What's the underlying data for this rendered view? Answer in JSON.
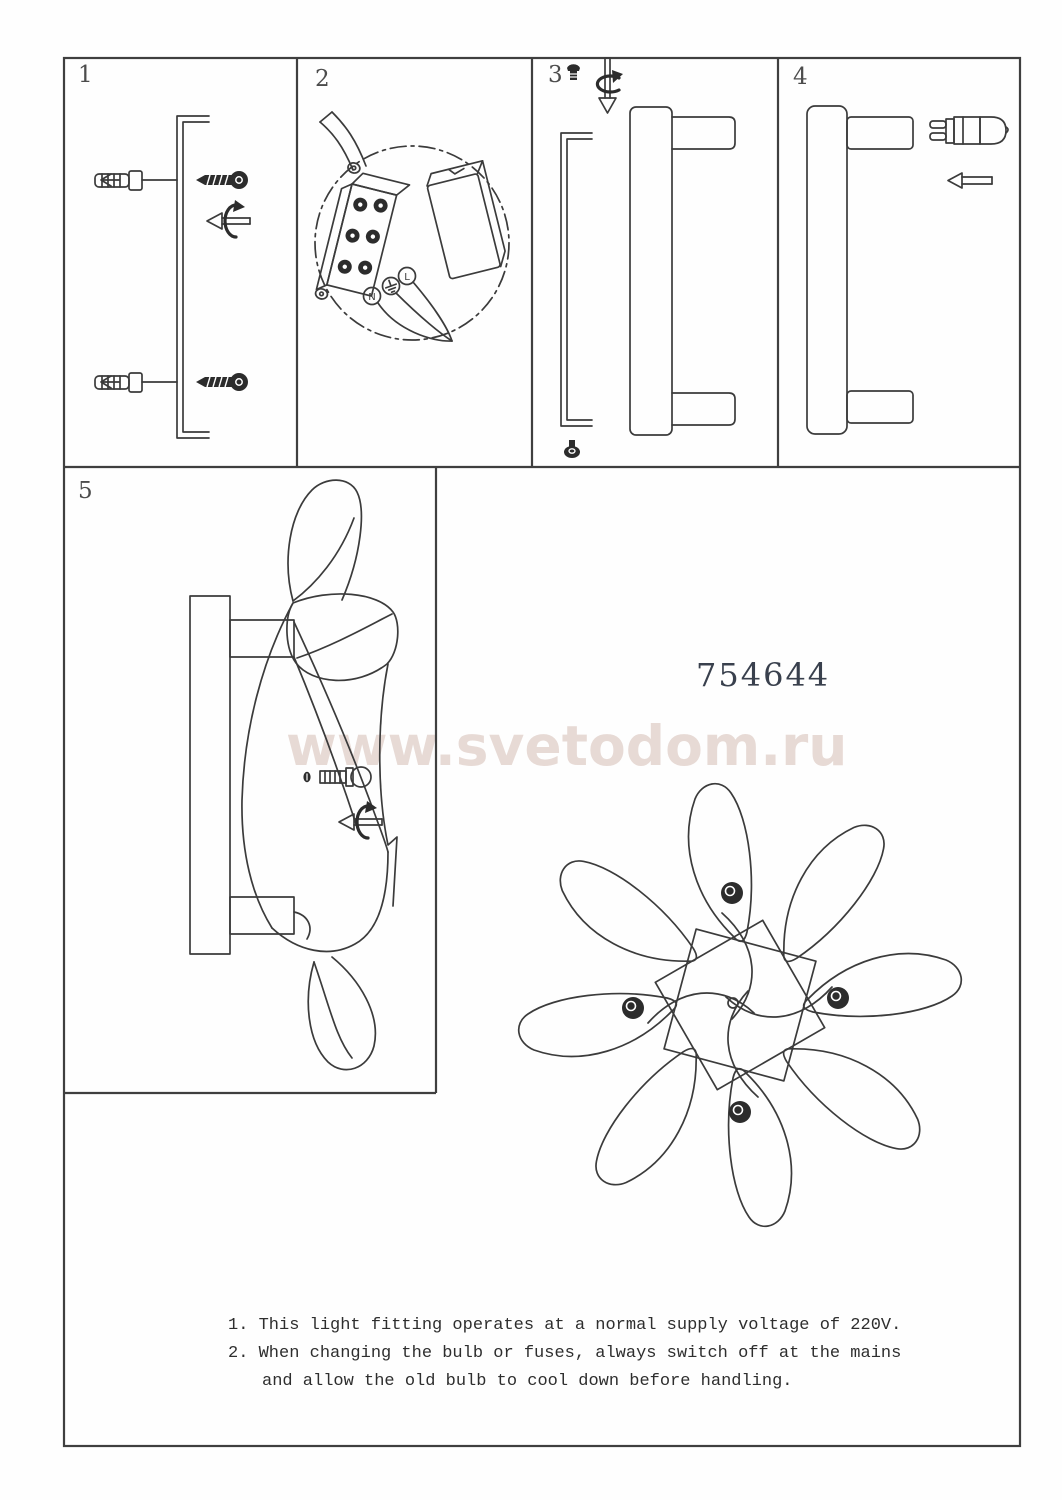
{
  "document": {
    "product_number": "754644",
    "watermark": "www.svetodom.ru",
    "notes": {
      "line1": "1. This light fitting operates at a normal supply voltage of 220V.",
      "line2": "2. When changing the bulb or fuses, always switch off at the mains",
      "line3": "and allow the old bulb to cool down before handling."
    }
  },
  "panels": {
    "p1": {
      "number": "1"
    },
    "p2": {
      "number": "2"
    },
    "p3": {
      "number": "3"
    },
    "p4": {
      "number": "4"
    },
    "p5": {
      "number": "5"
    }
  },
  "wiring": {
    "neutral": "N",
    "live": "L",
    "earth_icon": "earth-ground-symbol"
  },
  "icons": [
    "wall-anchor-icon",
    "screw-icon",
    "unscrew-rotation-arrow-icon",
    "screw-down-rotation-icon",
    "insert-arrow-icon",
    "g9-bulb-icon",
    "earth-symbol-icon"
  ],
  "colors": {
    "line": "#3b3b3b",
    "watermark": "#e7dad5",
    "text": "#2e2e2e",
    "paper": "#fefefe"
  }
}
